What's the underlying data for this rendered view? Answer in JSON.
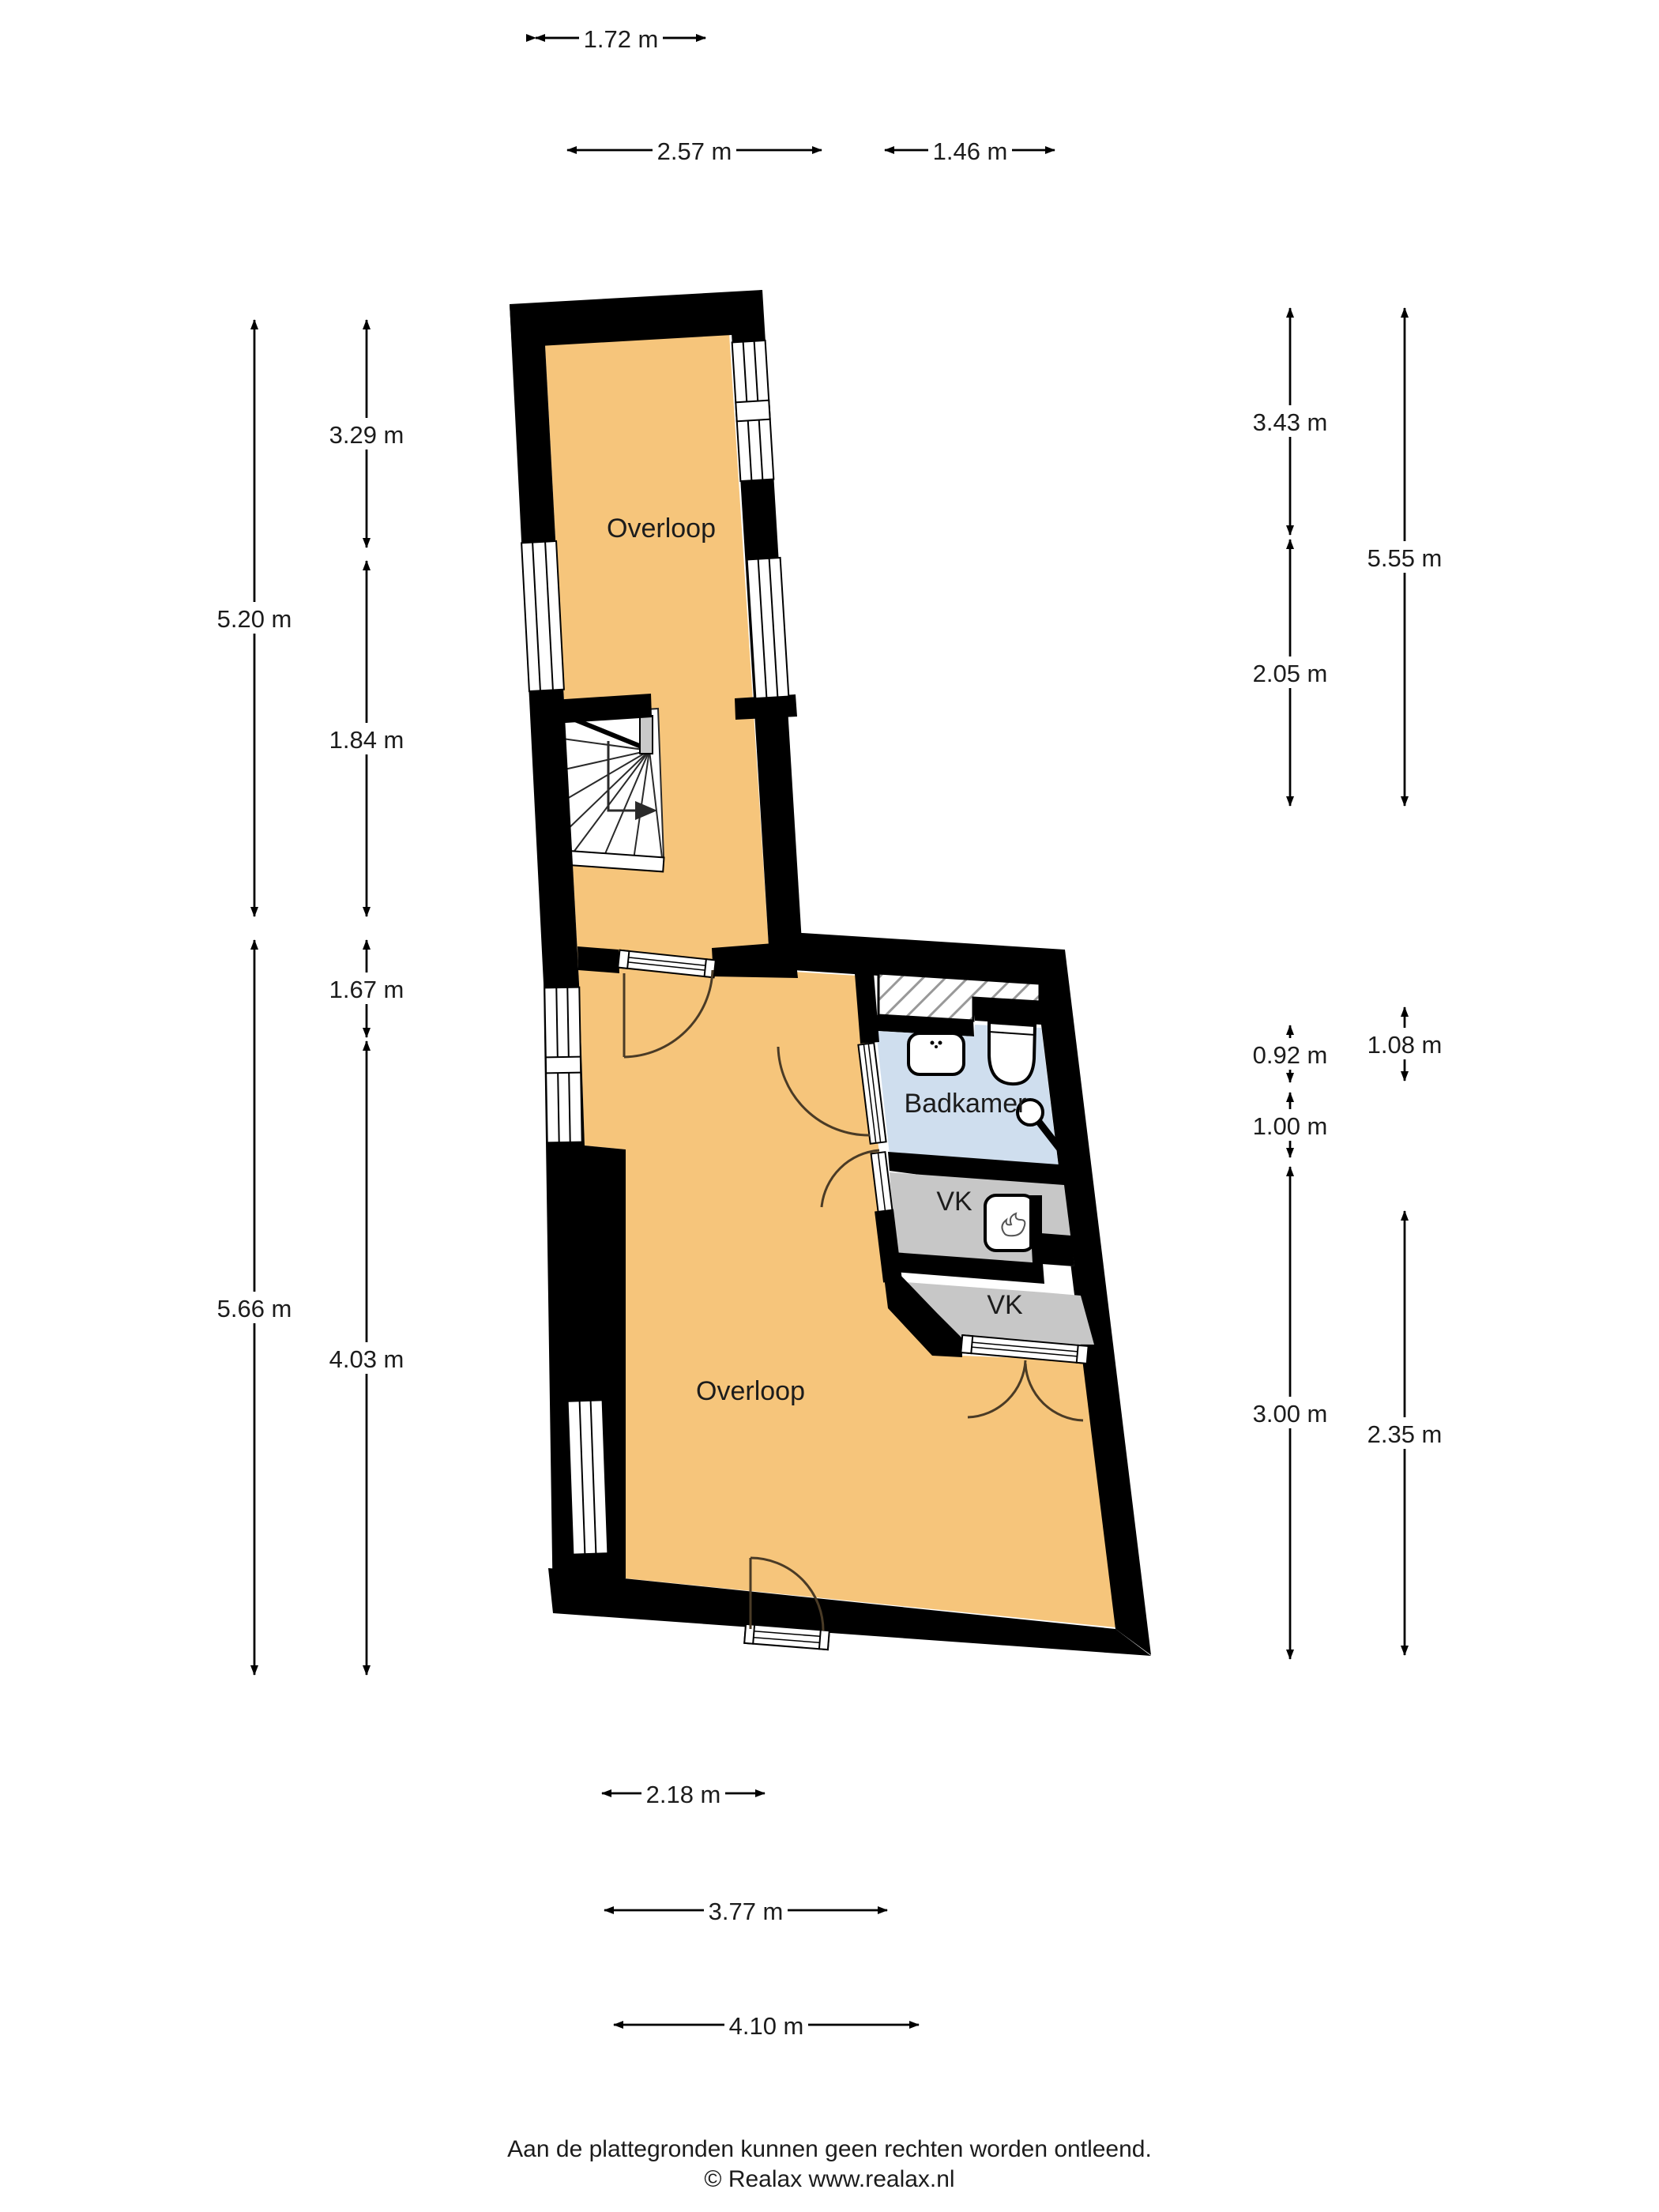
{
  "title": "Floor plan - verdieping (Realax)",
  "colors": {
    "floor": "#f6c57b",
    "bathroom": "#cfdeee",
    "closet": "#c7c7c7",
    "wall": "#000000",
    "hatch_line": "#999999",
    "door_arc": "#4a3b26",
    "stair_line": "#2a2a2a",
    "newel": "#c9c9c9",
    "text": "#1c1c1c"
  },
  "rooms": {
    "overloop_top": {
      "label": "Overloop"
    },
    "overloop_bottom": {
      "label": "Overloop"
    },
    "badkamer": {
      "label": "Badkamer"
    },
    "vk_upper": {
      "label": "VK"
    },
    "vk_lower": {
      "label": "VK"
    }
  },
  "dimensions": {
    "top": [
      {
        "label": "1.72 m"
      },
      {
        "label": "2.57 m"
      },
      {
        "label": "1.46 m"
      }
    ],
    "bottom": [
      {
        "label": "2.18 m"
      },
      {
        "label": "3.77 m"
      },
      {
        "label": "4.10 m"
      }
    ],
    "left": [
      {
        "label": "5.20 m"
      },
      {
        "label": "5.66 m"
      },
      {
        "label": "3.29 m"
      },
      {
        "label": "1.84 m"
      },
      {
        "label": "1.67 m"
      },
      {
        "label": "4.03 m"
      }
    ],
    "right": [
      {
        "label": "3.43 m"
      },
      {
        "label": "2.05 m"
      },
      {
        "label": "0.92 m"
      },
      {
        "label": "1.00 m"
      },
      {
        "label": "3.00 m"
      },
      {
        "label": "5.55 m"
      },
      {
        "label": "1.08 m"
      },
      {
        "label": "2.35 m"
      }
    ]
  },
  "footer": {
    "disclaimer": "Aan de plattegronden kunnen geen rechten worden ontleend.",
    "copyright": "© Realax www.realax.nl"
  }
}
